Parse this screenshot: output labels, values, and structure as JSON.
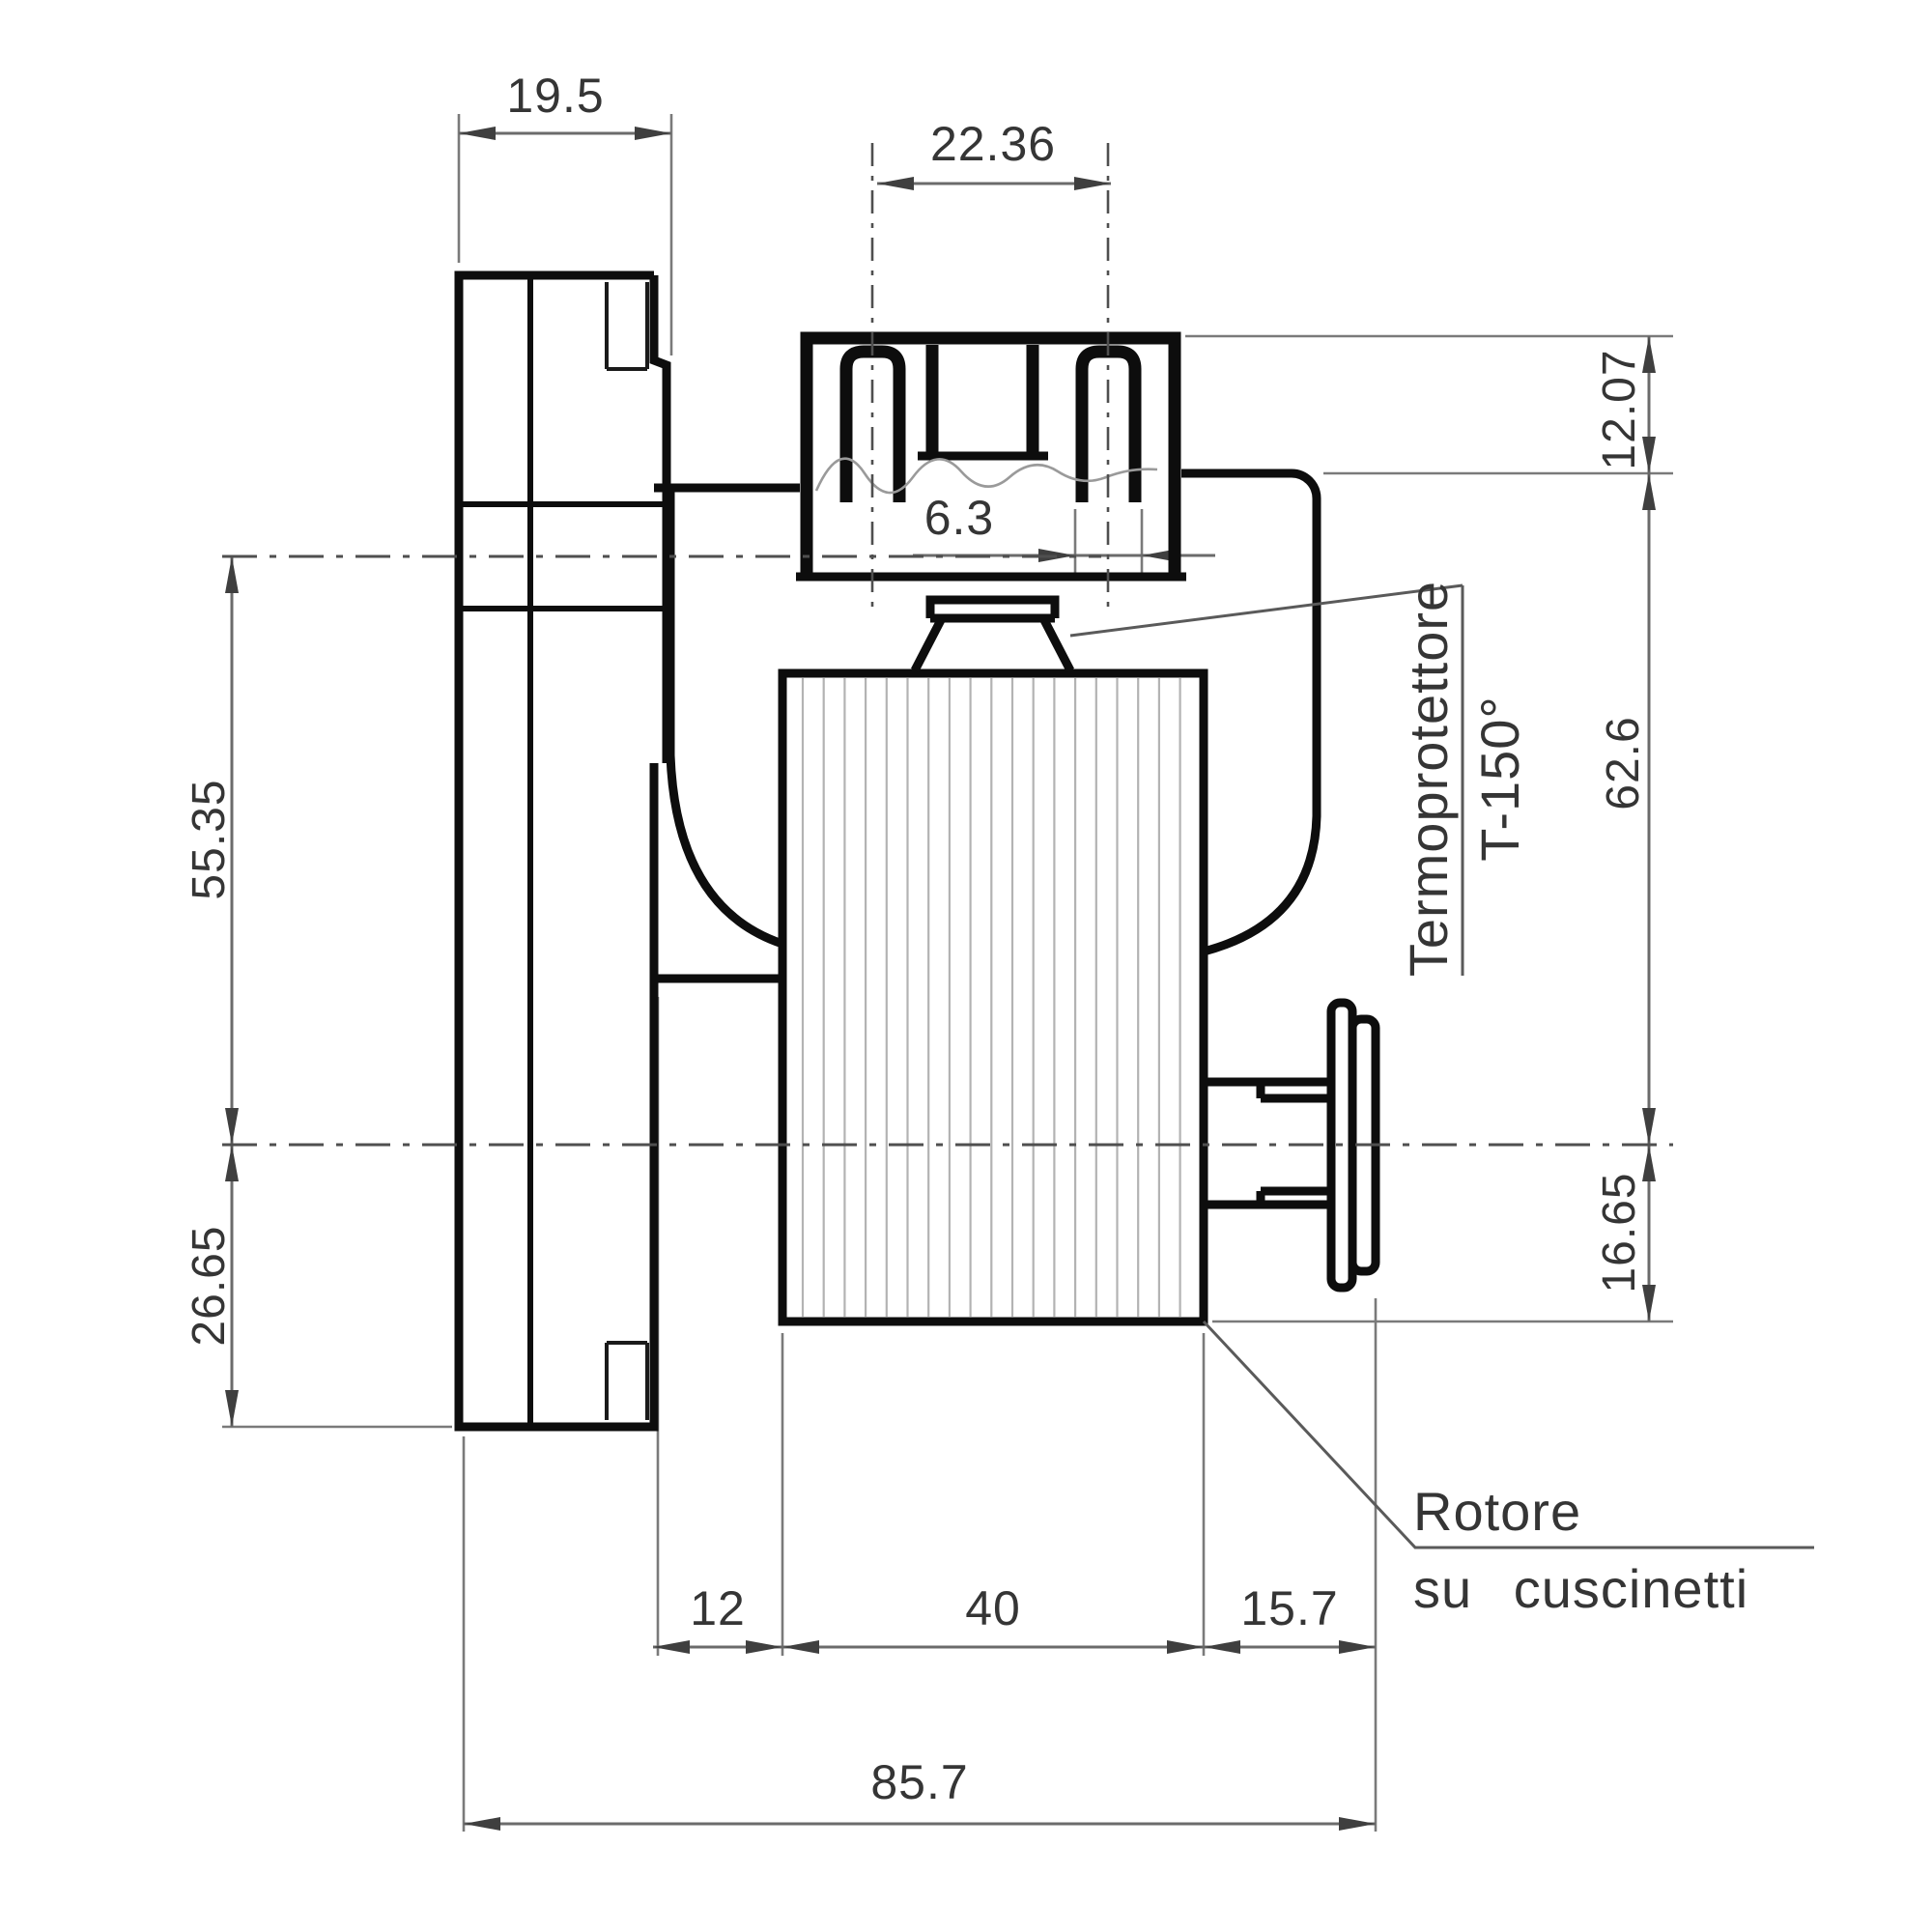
{
  "drawing": {
    "title": "gearmotor-side-view-technical-drawing",
    "units": "mm",
    "dims": {
      "flange_width": "19.5",
      "terminal_pitch": "22.36",
      "terminal_width": "6.3",
      "connector_top_offset": "12.07",
      "body_top_to_axis": "62.6",
      "axis_to_stator_bottom": "16.65",
      "output_center_to_axis": "55.35",
      "axis_to_flange_bottom": "26.65",
      "gearbox_depth": "12",
      "stator_length": "40",
      "shaft_end_length": "15.7",
      "overall_length": "85.7"
    },
    "labels": {
      "thermal_protector_line1": "Termoprotettore",
      "thermal_protector_line2": "T-150°",
      "rotor_note_line1": "Rotore",
      "rotor_note_line2": "su cuscinetti"
    },
    "colors": {
      "background": "#ffffff",
      "outline": "#0d0d0d",
      "dimension_line": "#6b6b6b",
      "arrow": "#3f3f3f",
      "text": "#353535",
      "hatch": "#b3b3b3",
      "centerline": "#4f4f4f"
    }
  }
}
